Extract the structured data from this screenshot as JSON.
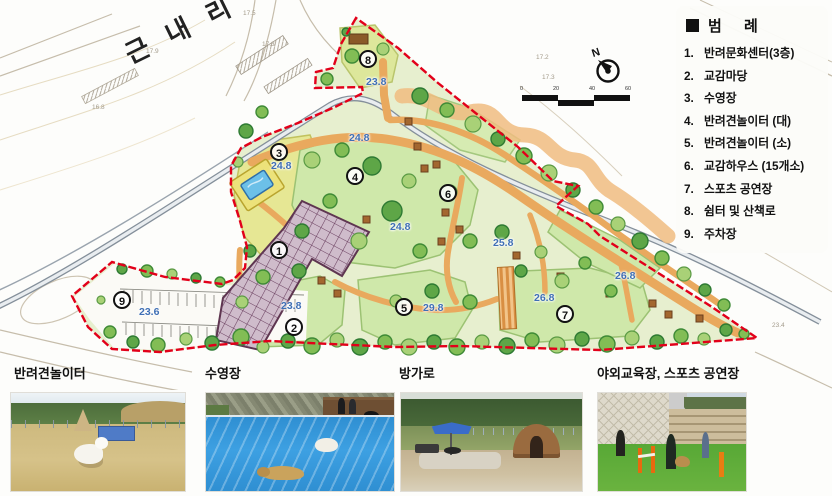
{
  "map": {
    "place_label": "근내리",
    "north_label": "N",
    "scale_labels": [
      "0",
      "20",
      "40",
      "60"
    ],
    "markers": [
      "1",
      "2",
      "3",
      "4",
      "5",
      "6",
      "7",
      "8",
      "9"
    ],
    "elevations": [
      "23.8",
      "24.8",
      "24.8",
      "24.8",
      "23.8",
      "29.8",
      "25.8",
      "26.8",
      "26.8",
      "23.6"
    ],
    "spot_heights": [
      "17.5",
      "17.9",
      "17.3",
      "16.8",
      "17.2",
      "17.3",
      "18.5",
      "23.4"
    ],
    "colors": {
      "boundary_red": "#e2001a",
      "path_orange": "#e9a95e",
      "lawn_green": "#cfe8aa",
      "tree_green": "#5ea647",
      "pool_blue": "#6cc0e8",
      "elevation_blue": "#3f6fb5",
      "building_outline": "#5e3550"
    }
  },
  "legend": {
    "title": "범 례",
    "items": [
      {
        "no": "1.",
        "label": "반려문화센터(3층)"
      },
      {
        "no": "2.",
        "label": "교감마당"
      },
      {
        "no": "3.",
        "label": "수영장"
      },
      {
        "no": "4.",
        "label": "반려견놀이터 (대)"
      },
      {
        "no": "5.",
        "label": "반려견놀이터 (소)"
      },
      {
        "no": "6.",
        "label": "교감하우스 (15개소)"
      },
      {
        "no": "7.",
        "label": "스포츠 공연장"
      },
      {
        "no": "8.",
        "label": "쉼터 및 산책로"
      },
      {
        "no": "9.",
        "label": "주차장"
      }
    ]
  },
  "photos": [
    {
      "label": "반려견놀이터"
    },
    {
      "label": "수영장"
    },
    {
      "label": "방가로"
    },
    {
      "label": "야외교육장, 스포츠 공연장"
    }
  ]
}
